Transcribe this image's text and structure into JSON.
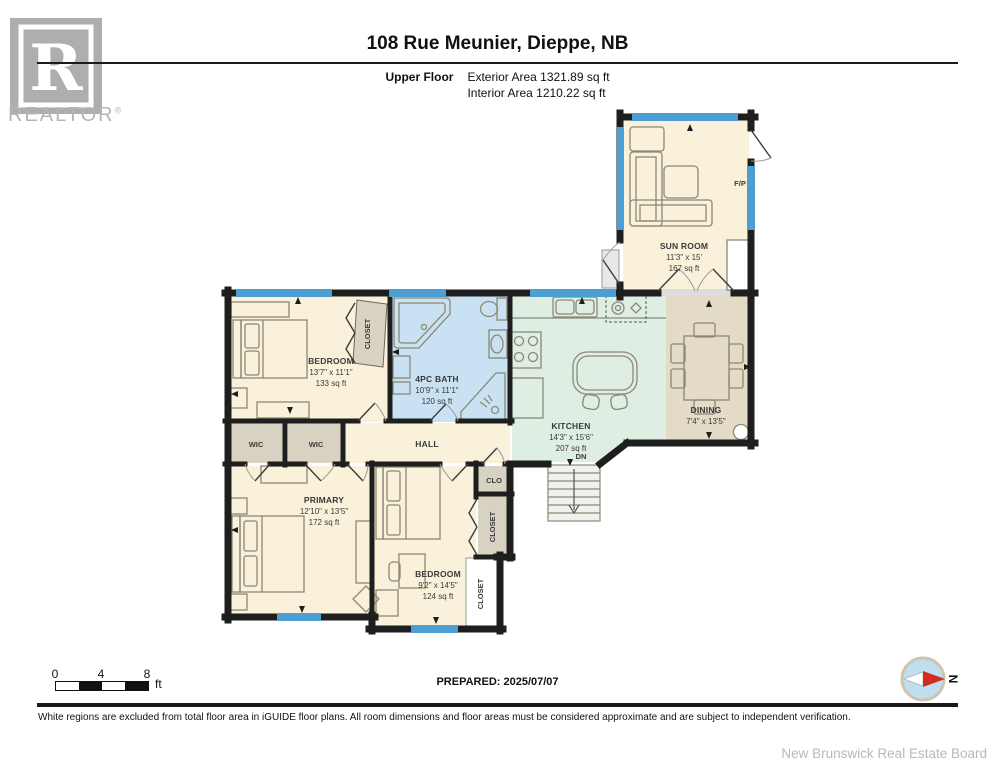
{
  "header": {
    "logo_r": "R",
    "logo_text": "REALTOR",
    "logo_reg": "®",
    "title": "108 Rue Meunier, Dieppe, NB",
    "floor_label": "Upper Floor",
    "exterior_area": "Exterior Area 1321.89 sq ft",
    "interior_area": "Interior Area 1210.22 sq ft"
  },
  "rooms": {
    "sunroom": {
      "name": "SUN ROOM",
      "dims": "11'3\" x 15'",
      "area": "167 sq ft"
    },
    "fp_label": "F/P",
    "bedroom1": {
      "name": "BEDROOM",
      "dims": "13'7\" x 11'1\"",
      "area": "133 sq ft"
    },
    "bedroom1_closet": "CLOSET",
    "bath": {
      "name": "4PC BATH",
      "dims": "10'9\" x 11'1\"",
      "area": "120 sq ft"
    },
    "kitchen": {
      "name": "KITCHEN",
      "dims": "14'3\" x 15'6\"",
      "area": "207 sq ft"
    },
    "stairs_dn": "DN",
    "dining": {
      "name": "DINING",
      "dims": "7'4\" x 13'5\""
    },
    "hall": "HALL",
    "wic_left": "WIC",
    "wic_right": "WIC",
    "primary": {
      "name": "PRIMARY",
      "dims": "12'10\" x 13'5\"",
      "area": "172 sq ft"
    },
    "bedroom2": {
      "name": "BEDROOM",
      "dims": "9'2\" x 14'5\"",
      "area": "124 sq ft"
    },
    "clo": "CLO",
    "closet_middle": "CLOSET",
    "closet_lower": "CLOSET"
  },
  "footer": {
    "scale_ticks": [
      "0",
      "4",
      "8"
    ],
    "scale_unit": "ft",
    "prepared": "PREPARED: 2025/07/07",
    "compass_north": "N",
    "disclaimer": "White regions are excluded from total floor area in iGUIDE floor plans. All room dimensions and floor areas must be considered approximate and are subject to independent verification.",
    "attribution": "New Brunswick Real Estate Board"
  },
  "colors": {
    "room_cream": "#FAF1DB",
    "room_tan": "#E4DBC6",
    "room_gray_tan": "#D8D2C2",
    "room_mint": "#DFEEE3",
    "room_bath_blue": "#C9E2F3",
    "closet_white": "#FFFFFF",
    "window_blue": "#4D9FD3",
    "wall_black": "#1E1E1E",
    "compass_red": "#D42B1E",
    "compass_fill": "#BFDFF0"
  }
}
